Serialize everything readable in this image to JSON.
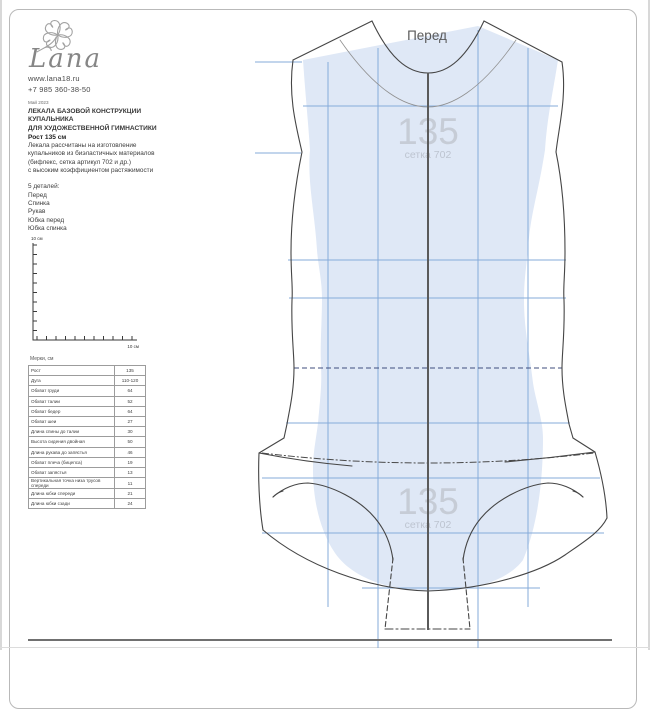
{
  "branding": {
    "logo_text": "Lana",
    "website": "www.lana18.ru",
    "phone": "+7 985 360-38-50"
  },
  "header": {
    "date": "Май 2023",
    "title_lines": [
      "ЛЕКАЛА БАЗОВОЙ КОНСТРУКЦИИ",
      "КУПАЛЬНИКА",
      "ДЛЯ ХУДОЖЕСТВЕННОЙ ГИМНАСТИКИ"
    ],
    "height": "Рост 135 см",
    "description_lines": [
      "Лекала рассчитаны на изготовление",
      "купальников из биэластичных материалов",
      "(бифлекс, сетка артикул 702 и др.)",
      "с высоким коэффициентом растяжимости"
    ],
    "details_header": "5 деталей:",
    "details": [
      "Перед",
      "Спинка",
      "Рукав",
      "Юбка перед",
      "Юбка спинка"
    ]
  },
  "scale_ruler": {
    "vertical_label": "10 см",
    "horizontal_label": "10 см"
  },
  "measurements": {
    "title": "Мерки, см",
    "rows": [
      {
        "name": "Рост",
        "value": "135"
      },
      {
        "name": "Дуга",
        "value": "110-120"
      },
      {
        "name": "Обхват груди",
        "value": "64"
      },
      {
        "name": "Обхват талии",
        "value": "52"
      },
      {
        "name": "Обхват бедер",
        "value": "64"
      },
      {
        "name": "Обхват шеи",
        "value": "27"
      },
      {
        "name": "Длина спины до талии",
        "value": "30"
      },
      {
        "name": "Высота сидения двойная",
        "value": "50"
      },
      {
        "name": "Длина рукава до запястья",
        "value": "46"
      },
      {
        "name": "Обхват плеча (бицепса)",
        "value": "19"
      },
      {
        "name": "Обхват запястья",
        "value": "13"
      },
      {
        "name": "Вертикальная точка низа трусов спереди",
        "value": "11"
      },
      {
        "name": "Длина юбки спереди",
        "value": "21"
      },
      {
        "name": "Длина юбки сзади",
        "value": "24"
      }
    ]
  },
  "pattern": {
    "piece_title": "Перед",
    "watermark_size": "135",
    "watermark_fabric": "сетка 702"
  },
  "colors": {
    "fabric_fill": "#dfe8f6",
    "grid_line": "#86abda",
    "outline": "#454545",
    "center_line": "#5a5a5a",
    "waist_dash": "#3f4e7e",
    "watermark": "#c6ccd6",
    "heading_text": "#595959"
  }
}
